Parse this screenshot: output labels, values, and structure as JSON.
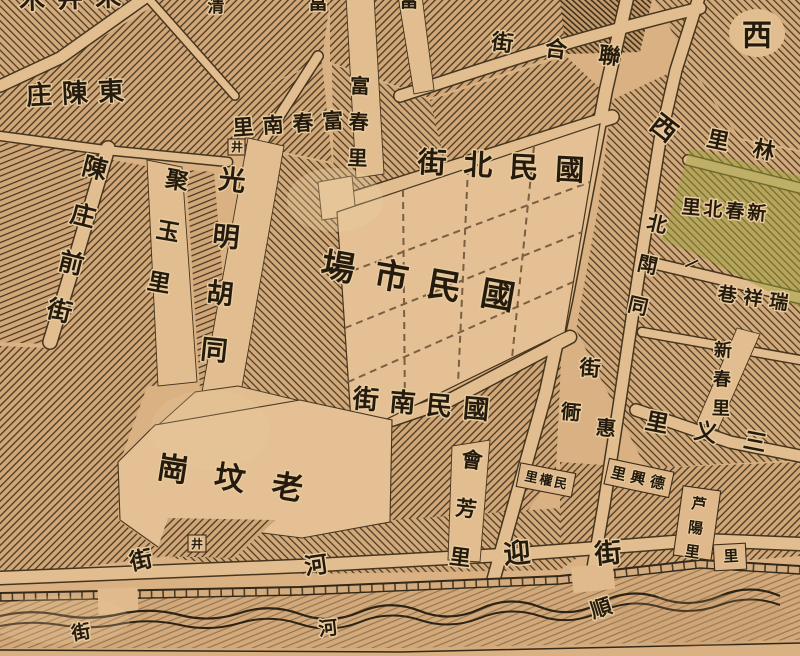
{
  "map": {
    "kind": "historical-chinese-street-map",
    "colors": {
      "paper": "#d6ac7d",
      "paper_light": "#e2bd8f",
      "hatch_line": "#44341f",
      "ink": "#241b0e",
      "halo": "#e8cb9e",
      "green_patch": "#9ba23d",
      "band": "#d4ab7c"
    },
    "well_symbol": "井",
    "labels": [
      {
        "name": "edge-top-left-clipped",
        "text": "朱井木",
        "x": 70,
        "y": -2,
        "size": 26,
        "rot": -2,
        "ls": 12,
        "rtl": true
      },
      {
        "name": "edge-top-clipped-qing",
        "text": "清",
        "x": 216,
        "y": 6,
        "size": 17
      },
      {
        "name": "edge-top-clipped-fu-1",
        "text": "富",
        "x": 318,
        "y": 2,
        "size": 20
      },
      {
        "name": "edge-top-clipped-fu-2",
        "text": "富",
        "x": 409,
        "y": 0,
        "size": 19
      },
      {
        "name": "dong-chen-zhuang",
        "text": "東陳庄",
        "x": 75,
        "y": 93,
        "size": 26,
        "rot": -3,
        "ls": 10,
        "rtl": true
      },
      {
        "name": "chenzhuang-front-street",
        "text": "陳庄前街",
        "x": 95,
        "y": 168,
        "size": 25,
        "dir": "v",
        "rot": 14,
        "lh": 49
      },
      {
        "name": "juyu-li",
        "text": "聚玉里",
        "x": 177,
        "y": 180,
        "size": 23,
        "dir": "v",
        "rot": 10,
        "lh": 52
      },
      {
        "name": "guangming-hutong",
        "text": "光明胡同",
        "x": 232,
        "y": 180,
        "size": 27,
        "dir": "v",
        "rot": 6,
        "lh": 57
      },
      {
        "name": "fuchun-south-li",
        "text": "富春南里",
        "x": 288,
        "y": 124,
        "size": 21,
        "rot": -4,
        "ls": 9,
        "rtl": true
      },
      {
        "name": "well-1",
        "text": "井",
        "x": 237,
        "y": 147,
        "size": 12
      },
      {
        "name": "fuchun-li",
        "text": "富春里",
        "x": 360,
        "y": 86,
        "size": 20,
        "dir": "v",
        "rot": 2,
        "lh": 36
      },
      {
        "name": "lianhe-street",
        "text": "聯合街",
        "x": 556,
        "y": 49,
        "size": 22,
        "rot": 7,
        "ls": 32,
        "rtl": true
      },
      {
        "name": "xi-top",
        "text": "西",
        "x": 757,
        "y": 35,
        "size": 30
      },
      {
        "name": "guomin-north-street",
        "text": "國民北街",
        "x": 501,
        "y": 166,
        "size": 29,
        "rot": 3,
        "ls": 17,
        "rtl": true
      },
      {
        "name": "xi-mid",
        "text": "西",
        "x": 664,
        "y": 128,
        "size": 26,
        "rot": 38
      },
      {
        "name": "lin-li-edge",
        "text": "林里",
        "x": 741,
        "y": 145,
        "size": 22,
        "rot": 12,
        "ls": 25,
        "rtl": true
      },
      {
        "name": "xinchun-north-li",
        "text": "新春北里",
        "x": 724,
        "y": 210,
        "size": 19,
        "rot": 5,
        "ls": 3,
        "rtl": true
      },
      {
        "name": "bei-dou-tong",
        "text": "北閗同",
        "x": 657,
        "y": 224,
        "size": 20,
        "dir": "v",
        "rot": 13,
        "lh": 42
      },
      {
        "name": "yi-lane-mark",
        "text": "一",
        "x": 692,
        "y": 264,
        "size": 15,
        "rot": -25
      },
      {
        "name": "ruixiang-alley",
        "text": "瑞祥巷",
        "x": 753,
        "y": 298,
        "size": 19,
        "rot": 8,
        "ls": 7,
        "rtl": true
      },
      {
        "name": "xinchun-li",
        "text": "新春里",
        "x": 723,
        "y": 350,
        "size": 18,
        "dir": "v",
        "rot": 2,
        "lh": 29
      },
      {
        "name": "sanyi-li",
        "text": "三义里",
        "x": 706,
        "y": 432,
        "size": 23,
        "rot": 11,
        "ls": 27,
        "rtl": true
      },
      {
        "name": "dexing-li",
        "text": "德興里",
        "x": 638,
        "y": 478,
        "size": 15,
        "rot": 13,
        "ls": 5,
        "rtl": true
      },
      {
        "name": "luyang-li",
        "text": "芦陽里",
        "x": 699,
        "y": 504,
        "size": 15,
        "dir": "v",
        "rot": 8,
        "lh": 24
      },
      {
        "name": "minquan-li",
        "text": "民權里",
        "x": 546,
        "y": 480,
        "size": 13,
        "rot": 12,
        "ls": 2,
        "rtl": true
      },
      {
        "name": "huifang-li",
        "text": "會芳里",
        "x": 472,
        "y": 460,
        "size": 21,
        "dir": "v",
        "rot": 7,
        "lh": 49
      },
      {
        "name": "ying-street-char",
        "text": "迎",
        "x": 517,
        "y": 553,
        "size": 27,
        "rot": -5
      },
      {
        "name": "jie-street-char-southeast",
        "text": "街",
        "x": 608,
        "y": 553,
        "size": 27,
        "rot": -5
      },
      {
        "name": "jie-street-char-mid",
        "text": "街",
        "x": 590,
        "y": 368,
        "size": 21,
        "rot": 5
      },
      {
        "name": "tong-street-char",
        "text": "衕",
        "x": 571,
        "y": 412,
        "size": 20,
        "rot": 5
      },
      {
        "name": "hui-street-char",
        "text": "惠",
        "x": 606,
        "y": 428,
        "size": 20,
        "rot": 5
      },
      {
        "name": "guomin-south-street",
        "text": "國民南街",
        "x": 421,
        "y": 404,
        "size": 26,
        "rot": 5,
        "ls": 11,
        "rtl": true
      },
      {
        "name": "guomin-market",
        "text": "國民市場",
        "x": 418,
        "y": 281,
        "size": 34,
        "rot": 10,
        "ls": 20,
        "rtl": true
      },
      {
        "name": "laofengang",
        "text": "老坟崗",
        "x": 230,
        "y": 478,
        "size": 31,
        "rot": 9,
        "ls": 27,
        "rtl": true
      },
      {
        "name": "well-2",
        "text": "井",
        "x": 197,
        "y": 544,
        "size": 12
      },
      {
        "name": "jie-above-band",
        "text": "街",
        "x": 141,
        "y": 560,
        "size": 23,
        "rot": -12
      },
      {
        "name": "he-above-band",
        "text": "河",
        "x": 316,
        "y": 565,
        "size": 23,
        "rot": -8
      },
      {
        "name": "shun-in-band",
        "text": "順",
        "x": 601,
        "y": 608,
        "size": 21,
        "rot": -18
      },
      {
        "name": "he-in-band",
        "text": "河",
        "x": 328,
        "y": 628,
        "size": 19,
        "rot": -6
      },
      {
        "name": "jie-in-band",
        "text": "街",
        "x": 81,
        "y": 632,
        "size": 19,
        "rot": -10
      },
      {
        "name": "li-box-edge",
        "text": "里",
        "x": 731,
        "y": 556,
        "size": 15,
        "rot": -3
      }
    ]
  }
}
